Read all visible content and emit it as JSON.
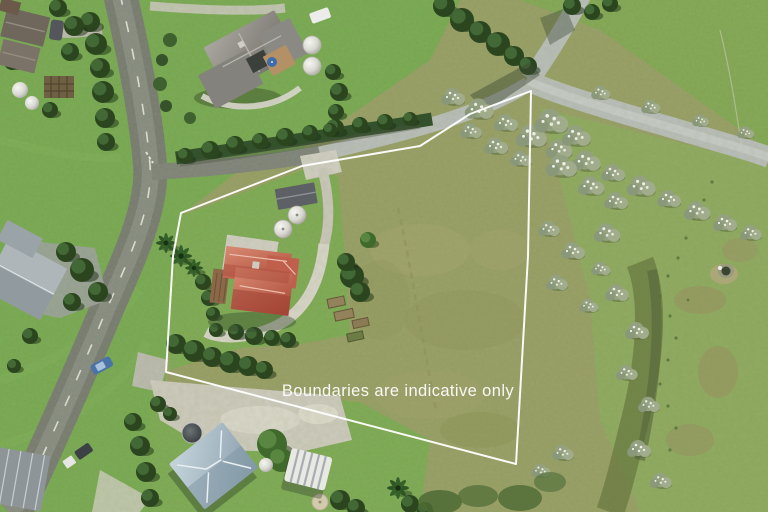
{
  "overlay": {
    "disclaimer_text": "Boundaries are indicative only"
  },
  "colors": {
    "boundary_line": "#ffffff",
    "overlay_text": "#ffffff"
  },
  "boundary": {
    "points": "531,91 470,114 420,146 302,166 240,190 181,213 173,256 166,372 516,464 528,256"
  }
}
